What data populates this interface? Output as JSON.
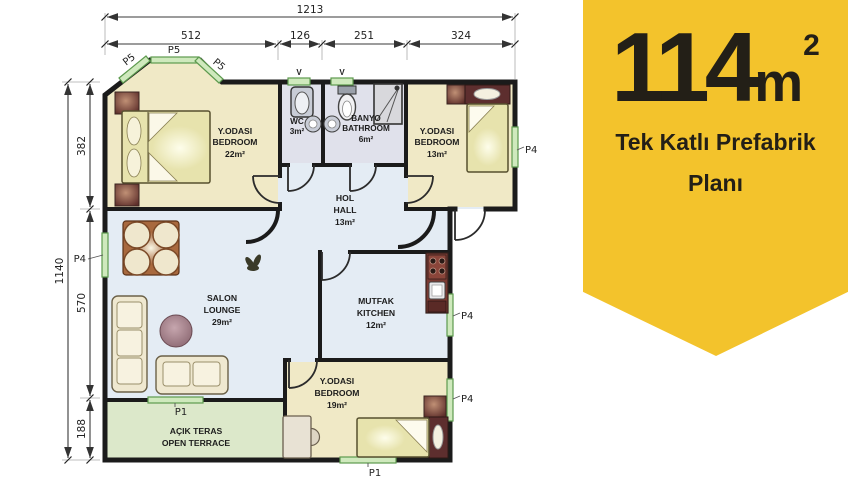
{
  "badge": {
    "area_value": "114",
    "area_unit": "m",
    "area_sup": "2",
    "title_line1": "Tek Katlı Prefabrik",
    "title_line2": "Planı",
    "bg_color": "#F3C32C",
    "text_color": "#231F17"
  },
  "dims": {
    "top_total": "1213",
    "top_segments": [
      "512",
      "126",
      "251",
      "324"
    ],
    "left_total": "1140",
    "left_segments": [
      "382",
      "570",
      "188"
    ]
  },
  "rooms": {
    "bedroom1": {
      "tr": "Y.ODASI",
      "en": "BEDROOM",
      "area": "22m²"
    },
    "wc": {
      "tr": "WC",
      "area": "3m²"
    },
    "bath": {
      "tr": "BANYO",
      "en": "BATHROOM",
      "area": "6m²"
    },
    "bedroom2": {
      "tr": "Y.ODASI",
      "en": "BEDROOM",
      "area": "13m²"
    },
    "hall": {
      "tr": "HOL",
      "en": "HALL",
      "area": "13m²"
    },
    "lounge": {
      "tr": "SALON",
      "en": "LOUNGE",
      "area": "29m²"
    },
    "kitchen": {
      "tr": "MUTFAK",
      "en": "KITCHEN",
      "area": "12m²"
    },
    "bedroom3": {
      "tr": "Y.ODASI",
      "en": "BEDROOM",
      "area": "19m²"
    },
    "terrace": {
      "tr": "AÇIK TERAS",
      "en": "OPEN TERRACE"
    }
  },
  "labels": {
    "p5": "P5",
    "p4": "P4",
    "p1": "P1",
    "vent": "V"
  },
  "colors": {
    "badge_bg": "#F3C32C",
    "badge_text": "#231F17",
    "wall": "#1B1B1B",
    "room_bedroom": "#F0E9C6",
    "room_wet": "#E0E1EB",
    "room_living": "#E4ECF4",
    "terrace": "#DCE8CA",
    "window_fill": "#CFE9BD",
    "window_border": "#5D9A4E",
    "furniture_wood": "#6A3A34",
    "bed_fill": "#E7E3AD"
  }
}
